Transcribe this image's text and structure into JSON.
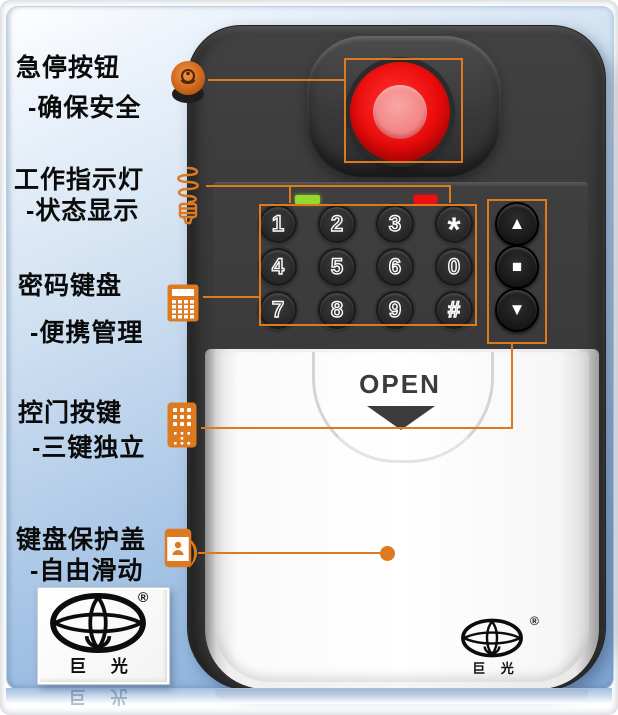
{
  "annotations": {
    "color": "#dd7a1f",
    "labels": [
      {
        "title": "急停按钮",
        "subtitle": "-确保安全"
      },
      {
        "title": "工作指示灯",
        "subtitle": "-状态显示"
      },
      {
        "title": "密码键盘",
        "subtitle": "-便携管理"
      },
      {
        "title": "控门按键",
        "subtitle": "-三键独立"
      },
      {
        "title": "键盘保护盖",
        "subtitle": "-自由滑动"
      }
    ]
  },
  "device": {
    "cover_label": "OPEN",
    "keypad_keys": [
      "1",
      "2",
      "3",
      "*",
      "4",
      "5",
      "6",
      "0",
      "7",
      "8",
      "9",
      "#"
    ],
    "side_buttons": [
      {
        "name": "up",
        "glyph": "▲"
      },
      {
        "name": "stop",
        "glyph": "■"
      },
      {
        "name": "down",
        "glyph": "▼"
      }
    ],
    "colors": {
      "body": "#3a3a3a",
      "emergency_outer": "#ec0b0b",
      "emergency_inner": "#f28080",
      "led_green": "#96d92e",
      "led_red": "#ee1010"
    }
  },
  "brand": {
    "name": "巨 光",
    "registered_mark": "®"
  }
}
